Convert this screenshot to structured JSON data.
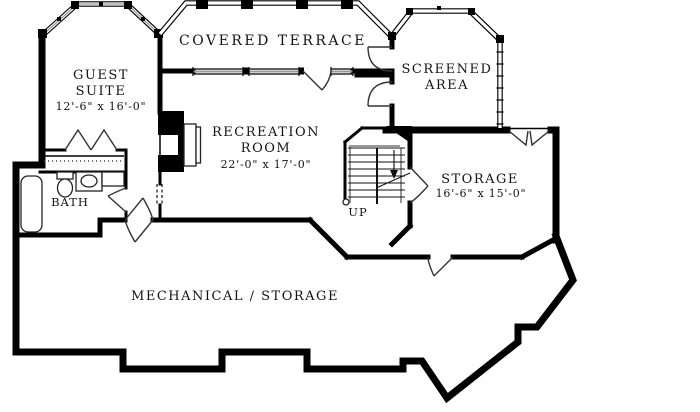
{
  "plan": {
    "type": "lower-level floor plan",
    "colors": {
      "walls": "#000000",
      "background": "#ffffff",
      "glazing_center": "#9a9a9a",
      "text": "#141414"
    }
  },
  "rooms": {
    "guest_suite": {
      "label_line1": "GUEST",
      "label_line2": "SUITE",
      "dimensions": "12'-6\" x 16'-0\""
    },
    "covered_terrace": {
      "label": "COVERED TERRACE"
    },
    "screened_area": {
      "label_line1": "SCREENED",
      "label_line2": "AREA"
    },
    "recreation_room": {
      "label_line1": "RECREATION",
      "label_line2": "ROOM",
      "dimensions": "22'-0\" x 17'-0\""
    },
    "storage": {
      "label": "STORAGE",
      "dimensions": "16'-6\" x 15'-0\""
    },
    "bath": {
      "label": "BATH"
    },
    "mechanical_storage": {
      "label": "MECHANICAL / STORAGE"
    },
    "stair": {
      "direction_label": "UP"
    }
  }
}
